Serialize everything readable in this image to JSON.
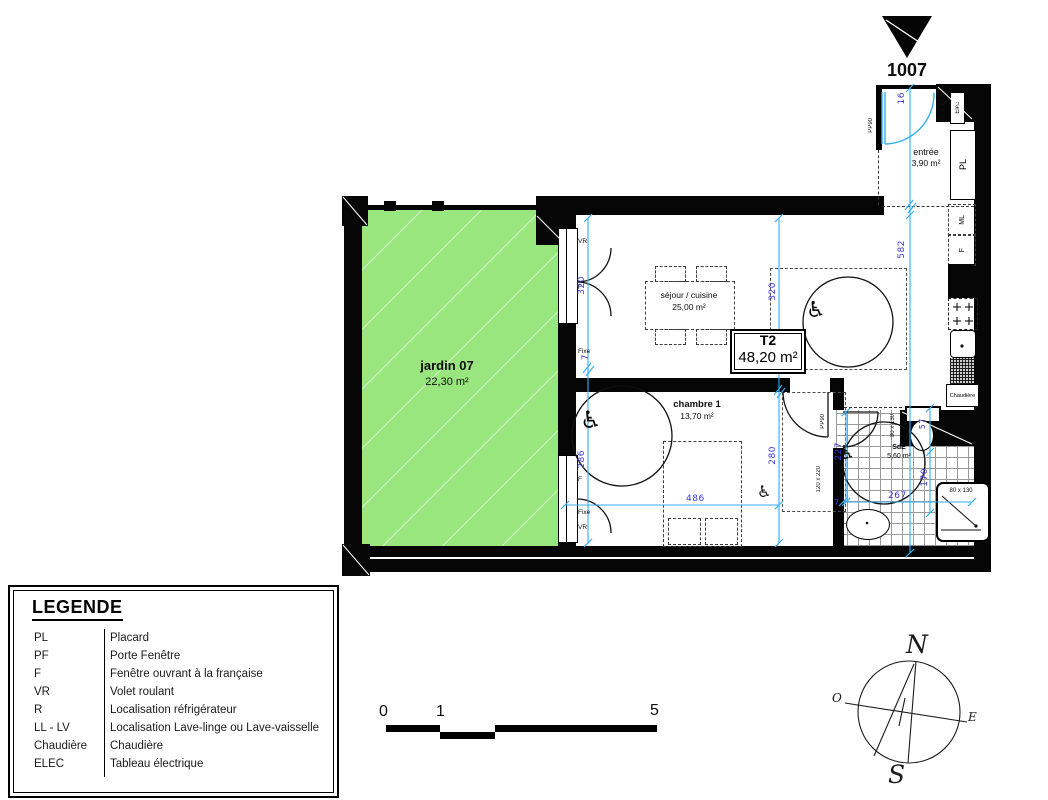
{
  "unit": {
    "number": "1007",
    "type": "T2",
    "area": "48,20 m²"
  },
  "rooms": {
    "jardin": {
      "name": "jardin 07",
      "area": "22,30 m²"
    },
    "sejour": {
      "name": "séjour / cuisine",
      "area": "25,00 m²"
    },
    "chambre": {
      "name": "chambre 1",
      "area": "13,70 m²"
    },
    "sde": {
      "name": "SdE",
      "area": "5,60 m²"
    },
    "entree": {
      "name": "entrée",
      "area": "3,90 m²"
    }
  },
  "dims": {
    "v16": "16",
    "v582": "582",
    "s320l": "320",
    "s7l": "7",
    "s286": "286",
    "s320m": "320",
    "s280": "280",
    "h486": "486",
    "h267": "267",
    "v227": "227",
    "v57": "57",
    "v170": "170",
    "v7b": "7"
  },
  "tags": {
    "vr": "VR",
    "f": "F",
    "fixe": "Fixe",
    "pl": "PL",
    "ml": "ML",
    "fbox": "F",
    "elec": "Elec",
    "elec_size": "20 x 220",
    "pp90": "PP90",
    "door_chambre": "120 x 220",
    "wc_size": "80 x 130",
    "shower_size": "80 x 130",
    "chaudiere": "Chaudière"
  },
  "icons": {
    "wheelchair": "♿"
  },
  "legend": {
    "title": "LEGENDE",
    "entries": [
      {
        "key": "PL",
        "desc": "Placard"
      },
      {
        "key": "PF",
        "desc": "Porte Fenêtre"
      },
      {
        "key": "F",
        "desc": "Fenêtre ouvrant à la française"
      },
      {
        "key": "VR",
        "desc": "Volet roulant"
      },
      {
        "key": "R",
        "desc": "Localisation réfrigérateur"
      },
      {
        "key": "LL - LV",
        "desc": "Localisation Lave-linge ou Lave-vaisselle"
      },
      {
        "key": "Chaudière",
        "desc": "Chaudière"
      },
      {
        "key": "ELEC",
        "desc": "Tableau électrique"
      }
    ]
  },
  "scale": {
    "t0": "0",
    "t1": "1",
    "t5": "5"
  },
  "compass": {
    "n": "N",
    "s": "S",
    "e": "E",
    "o": "O"
  }
}
